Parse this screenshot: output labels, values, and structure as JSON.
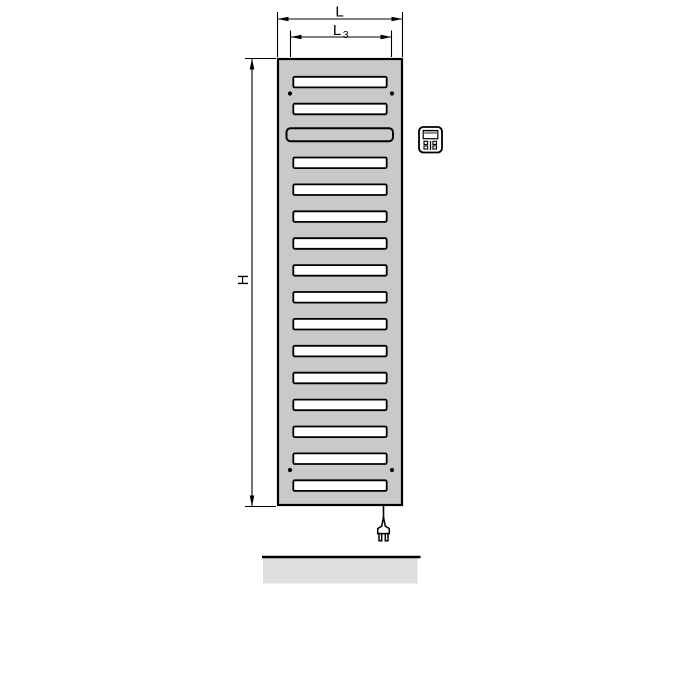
{
  "labels": {
    "total_width": "L",
    "inner_width_base": "L",
    "inner_width_sub": "3",
    "height": "H"
  },
  "colors": {
    "background": "#ffffff",
    "panel_fill": "#c9c9c9",
    "slot_fill": "#ffffff",
    "outline": "#000000",
    "floor_fill": "#dedede",
    "display_band": "#8a8a8a"
  },
  "icons": {
    "controller": "controller-icon",
    "plug": "power-plug-icon"
  },
  "layout": {
    "panel": {
      "x": 277,
      "y": 58,
      "width": 126,
      "height": 448
    },
    "slots": {
      "count": 16,
      "wide_index": 2,
      "first_top": 76.8,
      "pitch": 26.9,
      "regular": {
        "x": 293.3,
        "width": 93.4,
        "height": 10.6
      },
      "wide": {
        "x": 286.5,
        "width": 106.5,
        "height": 13,
        "top_offset": -2.4
      }
    },
    "mount_holes": {
      "xs": [
        290,
        392
      ],
      "ys": [
        93.5,
        470
      ],
      "r": 2.1
    }
  }
}
